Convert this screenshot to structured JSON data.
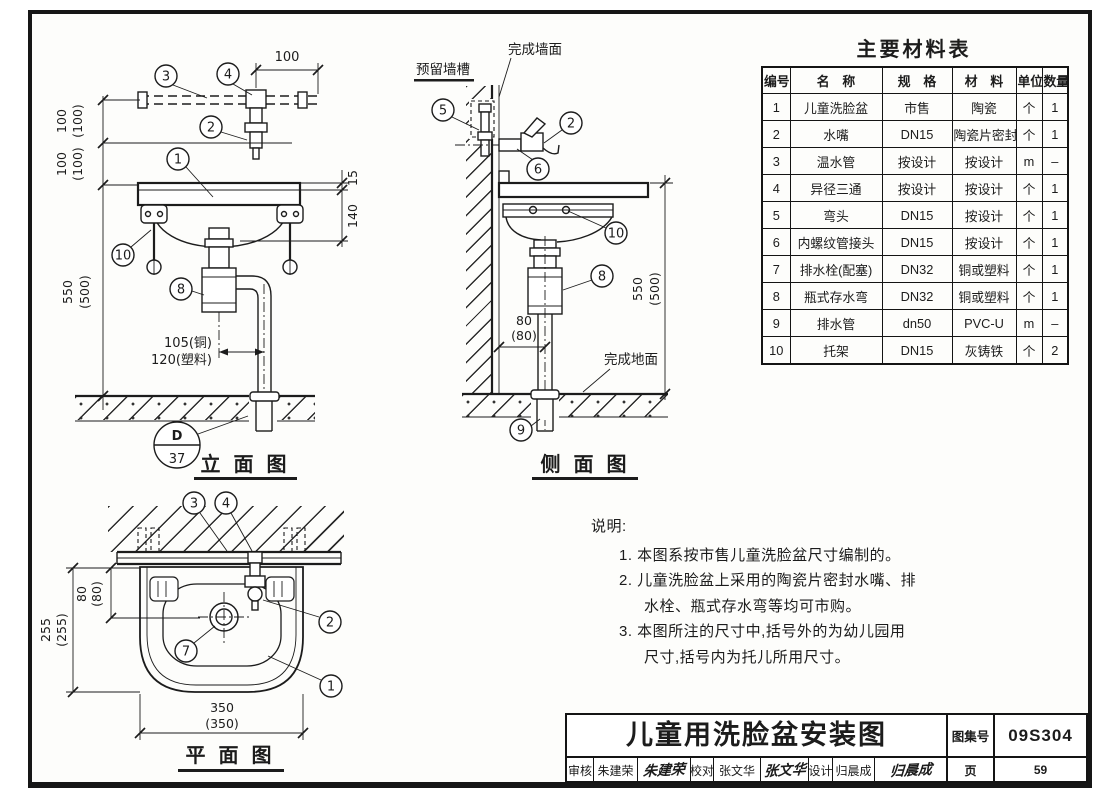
{
  "materials": {
    "title": "主要材料表",
    "headers": [
      "编号",
      "名　称",
      "规　格",
      "材　料",
      "单位",
      "数量"
    ],
    "rows": [
      [
        "1",
        "儿童洗脸盆",
        "市售",
        "陶瓷",
        "个",
        "1"
      ],
      [
        "2",
        "水嘴",
        "DN15",
        "陶瓷片密封",
        "个",
        "1"
      ],
      [
        "3",
        "温水管",
        "按设计",
        "按设计",
        "m",
        "–"
      ],
      [
        "4",
        "异径三通",
        "按设计",
        "按设计",
        "个",
        "1"
      ],
      [
        "5",
        "弯头",
        "DN15",
        "按设计",
        "个",
        "1"
      ],
      [
        "6",
        "内螺纹管接头",
        "DN15",
        "按设计",
        "个",
        "1"
      ],
      [
        "7",
        "排水栓(配塞)",
        "DN32",
        "铜或塑料",
        "个",
        "1"
      ],
      [
        "8",
        "瓶式存水弯",
        "DN32",
        "铜或塑料",
        "个",
        "1"
      ],
      [
        "9",
        "排水管",
        "dn50",
        "PVC-U",
        "m",
        "–"
      ],
      [
        "10",
        "托架",
        "DN15",
        "灰铸铁",
        "个",
        "2"
      ]
    ]
  },
  "notes": {
    "head": "说明:",
    "n1": "1. 本图系按市售儿童洗脸盆尺寸编制的。",
    "n2a": "2. 儿童洗脸盆上采用的陶瓷片密封水嘴、排",
    "n2b": "水栓、瓶式存水弯等均可市购。",
    "n3a": "3. 本图所注的尺寸中,括号外的为幼儿园用",
    "n3b": "尺寸,括号内为托儿所用尺寸。"
  },
  "titles": {
    "elevation": "立 面 图",
    "side": "侧 面 图",
    "plan": "平 面 图"
  },
  "callouts": {
    "1": "1",
    "2": "2",
    "3": "3",
    "4": "4",
    "5": "5",
    "6": "6",
    "7": "7",
    "8": "8",
    "9": "9",
    "10": "10"
  },
  "detail": {
    "letter": "D",
    "sheet": "37"
  },
  "dims": {
    "d100": "100",
    "p100": "(100)",
    "d550": "550",
    "p500": "(500)",
    "d15": "15",
    "d140": "140",
    "d80": "80",
    "p80": "(80)",
    "d350": "350",
    "p350": "(350)",
    "d255": "255",
    "p255": "(255)",
    "copper": "105(铜)",
    "plastic": "120(塑料)"
  },
  "anno": {
    "finished_wall": "完成墙面",
    "wall_chase": "预留墙槽",
    "finished_floor": "完成地面"
  },
  "titleblock": {
    "title": "儿童用洗脸盆安装图",
    "atlas_label": "图集号",
    "atlas_no": "09S304",
    "page_label": "页",
    "page_no": "59",
    "review_label": "审核",
    "review_name": "朱建荣",
    "review_sig": "朱建荣",
    "check_label": "校对",
    "check_name": "张文华",
    "check_sig": "张文华",
    "design_label": "设计",
    "design_name": "归晨成",
    "design_sig": "归晨成"
  }
}
